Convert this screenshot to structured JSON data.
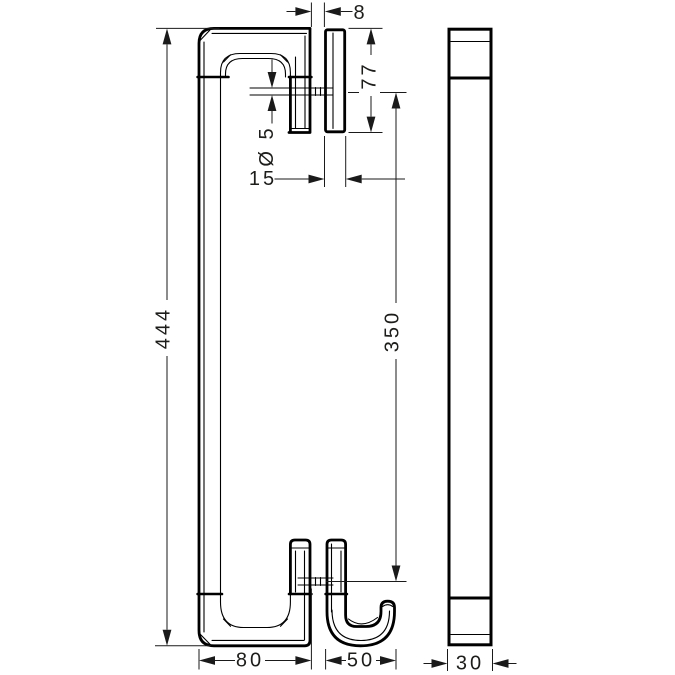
{
  "colors": {
    "background": "#ffffff",
    "line": "#000000",
    "text": "#1d1d1b"
  },
  "dimensions": {
    "overall_height": {
      "label": "444"
    },
    "pin_spacing": {
      "label": "350"
    },
    "clamp_height": {
      "label": "77"
    },
    "glass_gap": {
      "label": "8"
    },
    "pin_diameter": {
      "label": "Ø 5"
    },
    "clamp_depth": {
      "label": "15"
    },
    "body_depth": {
      "label": "80"
    },
    "hook_depth": {
      "label": "50"
    },
    "profile_width": {
      "label": "30"
    }
  }
}
